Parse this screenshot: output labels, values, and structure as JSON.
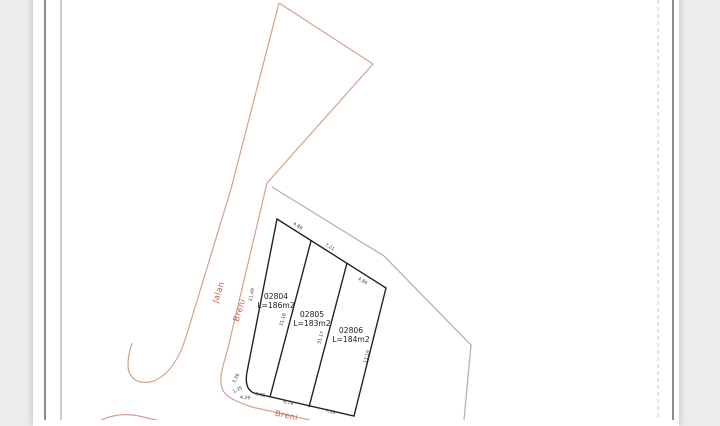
{
  "drawing": {
    "road": {
      "name_word1": "Jalan",
      "name_word2": "Breni",
      "bottom_label": "Breni",
      "line_color": "#d5a18d",
      "text_color": "#c2604a"
    },
    "adjacent_boundary_color": "#b3b3b3",
    "parcel_line_color": "#222222",
    "parcels": [
      {
        "id": "02804",
        "area_label": "L=186m2"
      },
      {
        "id": "02805",
        "area_label": "L=183m2"
      },
      {
        "id": "02806",
        "area_label": "L=184m2"
      }
    ],
    "dimensions": {
      "top": [
        "4,89",
        "7,21",
        "4,86"
      ],
      "right": "13,19",
      "left": "21,49",
      "divider1": "31,18",
      "divider2": "31,17",
      "bottom": [
        "5,95",
        "6,79",
        "7,59"
      ],
      "corner": [
        "3,36",
        "1,35",
        "4,29"
      ]
    }
  }
}
